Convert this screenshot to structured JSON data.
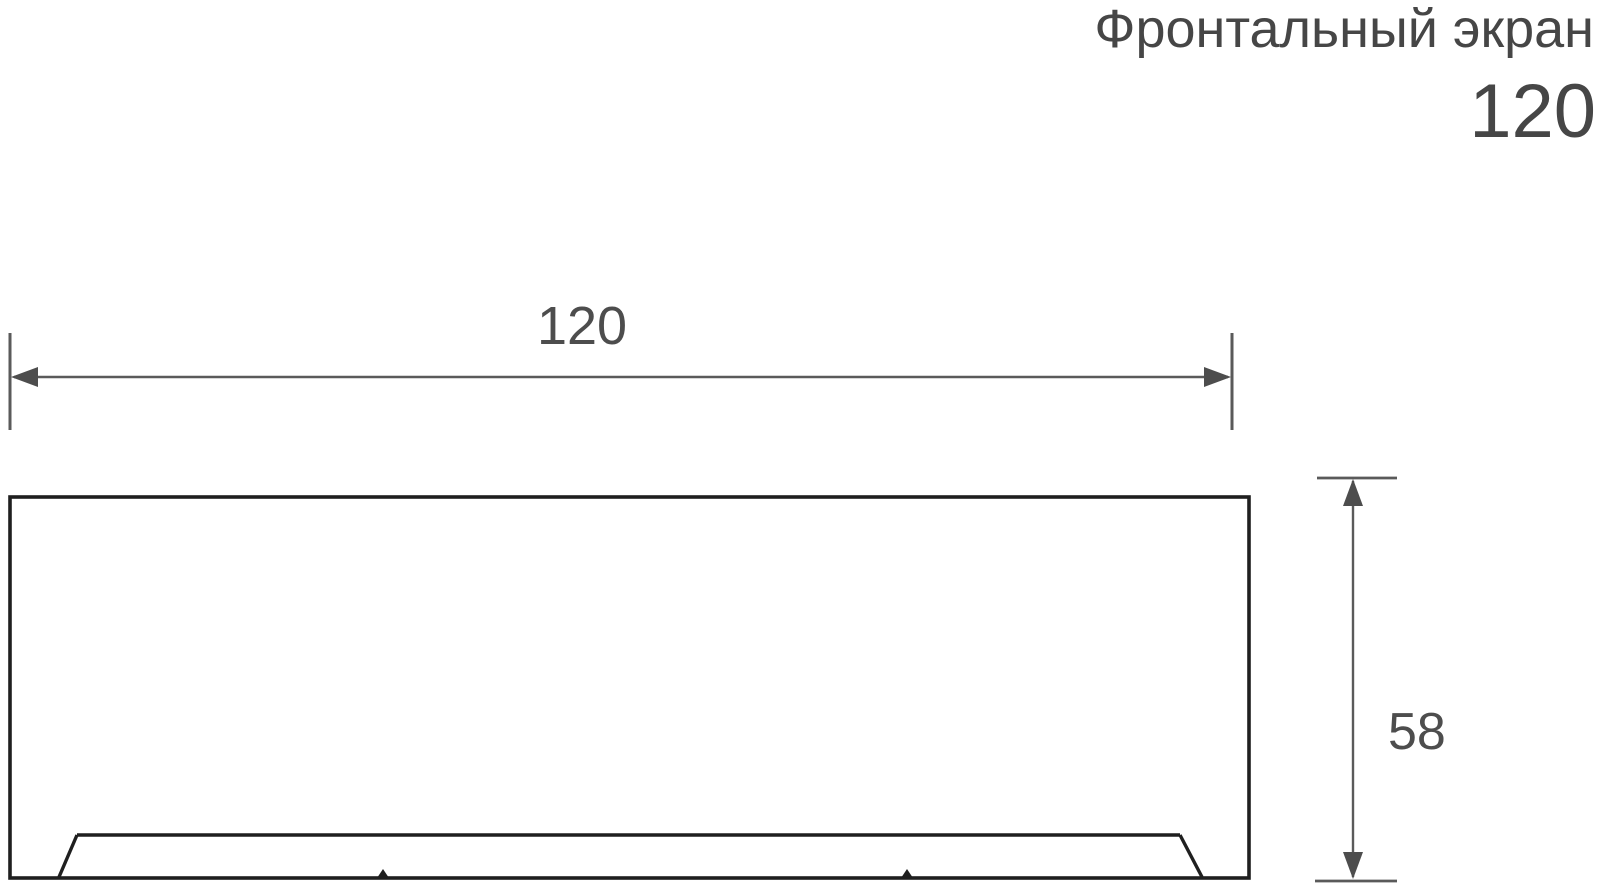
{
  "title": {
    "line1": "Фронтальный экран",
    "line2": "120"
  },
  "dimensions": {
    "width": {
      "label": "120"
    },
    "height": {
      "label": "58"
    }
  },
  "colors": {
    "background": "#ffffff",
    "text": "#464646",
    "outline": "#1f1f1f",
    "dimension_line": "#5a5a5a",
    "arrow": "#4d4d4d"
  }
}
